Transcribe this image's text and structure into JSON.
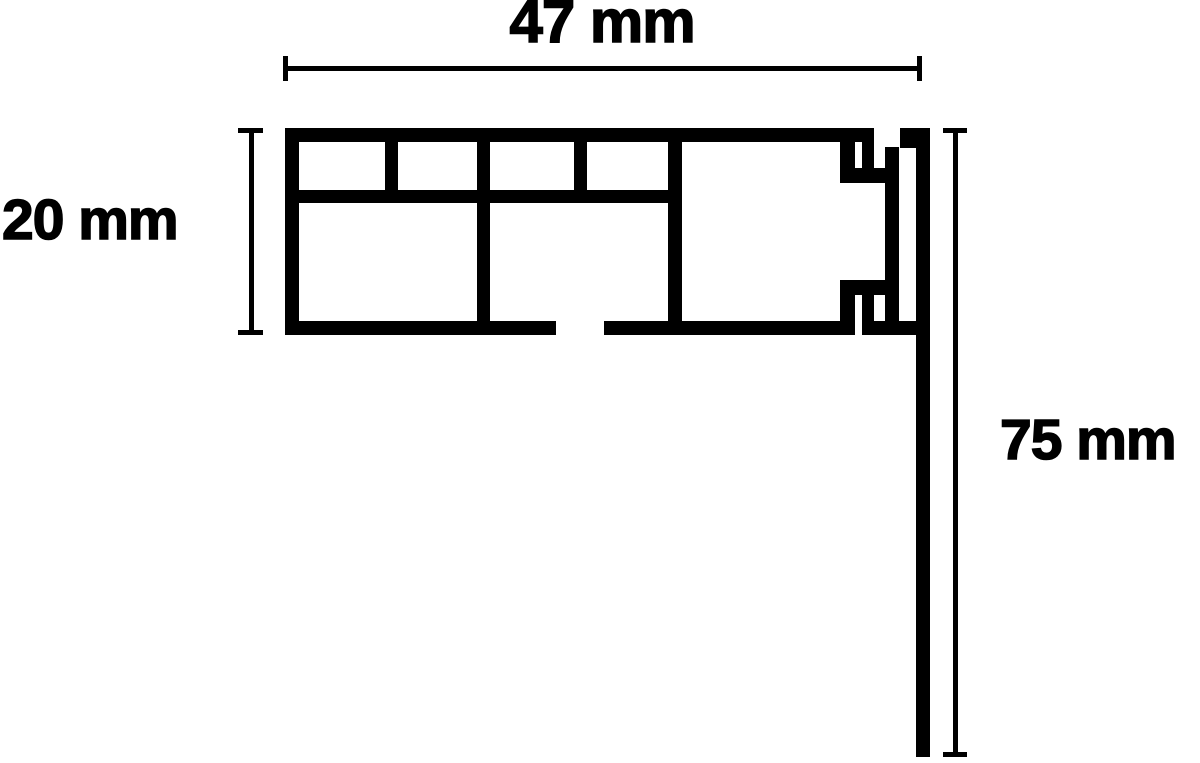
{
  "title": "Curtain rail profile cross-section with dimensions",
  "dimensions": {
    "width_label": "47 mm",
    "height_label": "20 mm",
    "drop_label": "75 mm",
    "width_mm": 47,
    "height_mm": 20,
    "drop_mm": 75
  },
  "colors": {
    "ink": "#000000",
    "background": "#ffffff"
  },
  "diagram": {
    "description": "Cross-section of a multi-chamber curtain track profile (47 mm wide, 20 mm high) with snap-on hook detail at the right end holding a 75 mm front fascia panel",
    "shapes": [
      {
        "name": "profile-top-wall",
        "x": 285,
        "y": 128,
        "w": 589,
        "h": 14
      },
      {
        "name": "profile-left-wall",
        "x": 285,
        "y": 128,
        "w": 14,
        "h": 207
      },
      {
        "name": "profile-mid-web",
        "x": 285,
        "y": 190,
        "w": 397,
        "h": 13
      },
      {
        "name": "profile-bottom-wall-left",
        "x": 285,
        "y": 321,
        "w": 271,
        "h": 14
      },
      {
        "name": "profile-bottom-wall-mid",
        "x": 604,
        "y": 321,
        "w": 251,
        "h": 14
      },
      {
        "name": "profile-bottom-wall-right",
        "x": 862,
        "y": 321,
        "w": 68,
        "h": 14
      },
      {
        "name": "profile-divider-1",
        "x": 385,
        "y": 128,
        "w": 13,
        "h": 75
      },
      {
        "name": "profile-divider-2",
        "x": 477,
        "y": 128,
        "w": 13,
        "h": 207
      },
      {
        "name": "profile-divider-3",
        "x": 574,
        "y": 128,
        "w": 13,
        "h": 75
      },
      {
        "name": "profile-divider-4",
        "x": 668,
        "y": 128,
        "w": 14,
        "h": 207
      },
      {
        "name": "hook-top-wall-stub",
        "x": 840,
        "y": 142,
        "w": 15,
        "h": 26
      },
      {
        "name": "hook-top-hanging-stub",
        "x": 862,
        "y": 142,
        "w": 12,
        "h": 26
      },
      {
        "name": "hook-top-ledge",
        "x": 840,
        "y": 168,
        "w": 45,
        "h": 15
      },
      {
        "name": "fascia-inner-rib",
        "x": 885,
        "y": 147,
        "w": 14,
        "h": 188
      },
      {
        "name": "fascia-top-arm",
        "x": 900,
        "y": 128,
        "w": 30,
        "h": 20
      },
      {
        "name": "fascia-front-panel",
        "x": 916,
        "y": 128,
        "w": 14,
        "h": 629
      },
      {
        "name": "hook-bottom-ledge",
        "x": 840,
        "y": 280,
        "w": 45,
        "h": 15
      },
      {
        "name": "hook-bottom-wall-stub",
        "x": 840,
        "y": 295,
        "w": 15,
        "h": 26
      },
      {
        "name": "hook-bottom-rising-stub",
        "x": 862,
        "y": 295,
        "w": 12,
        "h": 26
      },
      {
        "name": "dim-width-line",
        "x": 285,
        "y": 66,
        "w": 635,
        "h": 5
      },
      {
        "name": "dim-width-tick-left",
        "x": 283,
        "y": 56,
        "w": 5,
        "h": 25
      },
      {
        "name": "dim-width-tick-right",
        "x": 917,
        "y": 56,
        "w": 5,
        "h": 25
      },
      {
        "name": "dim-height-line",
        "x": 249,
        "y": 128,
        "w": 5,
        "h": 207
      },
      {
        "name": "dim-height-tick-top",
        "x": 238,
        "y": 128,
        "w": 25,
        "h": 5
      },
      {
        "name": "dim-height-tick-bottom",
        "x": 238,
        "y": 330,
        "w": 25,
        "h": 5
      },
      {
        "name": "dim-drop-line",
        "x": 953,
        "y": 128,
        "w": 5,
        "h": 629
      },
      {
        "name": "dim-drop-tick-top",
        "x": 943,
        "y": 128,
        "w": 24,
        "h": 5
      },
      {
        "name": "dim-drop-tick-bottom",
        "x": 943,
        "y": 752,
        "w": 24,
        "h": 5
      }
    ]
  }
}
